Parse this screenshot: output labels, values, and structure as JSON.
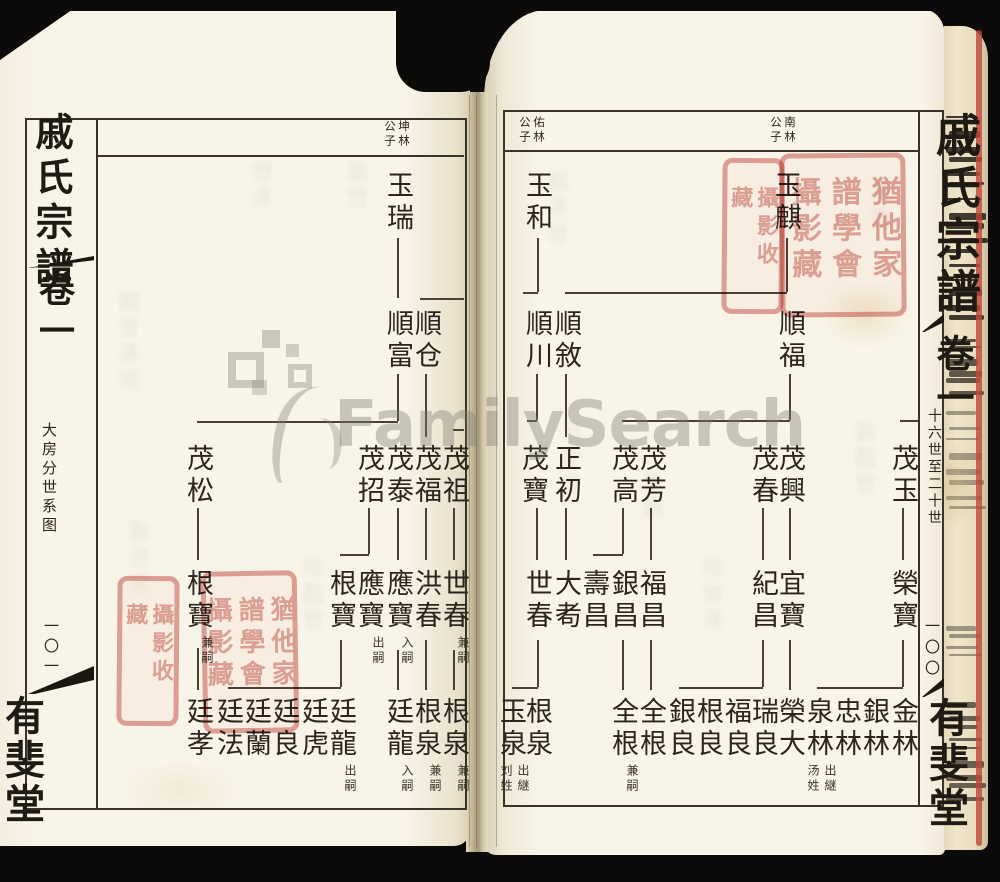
{
  "watermark": {
    "text": "FamilySearch"
  },
  "seals": {
    "large_text": "猶他家譜學會攝影藏",
    "small_text": "攝影收藏"
  },
  "pages": {
    "left": {
      "page_number": "一〇一",
      "margin": {
        "title": "戚氏宗譜",
        "volume": "卷一",
        "section": "大房分世系图",
        "hall": "有斐堂"
      },
      "headers": [
        "坤林公子"
      ],
      "nodes": [
        {
          "name": "玉瑞",
          "col": 7,
          "row": 0
        },
        {
          "name": "順富",
          "col": 7,
          "row": 1
        },
        {
          "name": "順仓",
          "col": 8,
          "row": 1
        },
        {
          "name": "茂松",
          "col": 0,
          "row": 2
        },
        {
          "name": "茂招",
          "col": 6,
          "row": 2
        },
        {
          "name": "茂泰",
          "col": 7,
          "row": 2
        },
        {
          "name": "茂福",
          "col": 8,
          "row": 2
        },
        {
          "name": "茂祖",
          "col": 9,
          "row": 2
        },
        {
          "name": "根寶",
          "note": "兼嗣",
          "col": 0,
          "row": 3
        },
        {
          "name": "根寶",
          "col": 5,
          "row": 3
        },
        {
          "name": "應寶",
          "note": "出嗣",
          "col": 6,
          "row": 3
        },
        {
          "name": "應寶",
          "note": "入嗣",
          "col": 7,
          "row": 3
        },
        {
          "name": "洪春",
          "col": 8,
          "row": 3
        },
        {
          "name": "世春",
          "note": "兼嗣",
          "col": 9,
          "row": 3
        },
        {
          "name": "廷孝",
          "col": 0,
          "row": 4
        },
        {
          "name": "廷法",
          "col": 1,
          "row": 4
        },
        {
          "name": "廷蘭",
          "col": 2,
          "row": 4
        },
        {
          "name": "廷良",
          "col": 3,
          "row": 4
        },
        {
          "name": "廷虎",
          "col": 4,
          "row": 4
        },
        {
          "name": "廷龍",
          "note": "出嗣",
          "col": 5,
          "row": 4
        },
        {
          "name": "廷龍",
          "note": "入嗣",
          "col": 7,
          "row": 4
        },
        {
          "name": "根泉",
          "note": "兼嗣",
          "col": 8,
          "row": 4
        },
        {
          "name": "根泉",
          "note": "兼嗣",
          "col": 9,
          "row": 4
        }
      ]
    },
    "right": {
      "page_number": "一〇〇",
      "margin": {
        "title": "戚氏宗譜",
        "volume": "卷一",
        "section": "十六世至二十世",
        "hall": "有斐堂"
      },
      "headers": [
        "佑林公子",
        "南林公子"
      ],
      "nodes": [
        {
          "name": "玉和",
          "col": 1,
          "row": 0
        },
        {
          "name": "玉麒",
          "col": 10,
          "row": 0,
          "dx": -4
        },
        {
          "name": "順川",
          "col": 1,
          "row": 1
        },
        {
          "name": "順敘",
          "col": 2,
          "row": 1
        },
        {
          "name": "順福",
          "col": 10,
          "row": 1
        },
        {
          "name": "茂寶",
          "col": 1,
          "row": 2,
          "dx": -4
        },
        {
          "name": "正初",
          "col": 2,
          "row": 2
        },
        {
          "name": "茂高",
          "col": 4,
          "row": 2
        },
        {
          "name": "茂芳",
          "col": 5,
          "row": 2
        },
        {
          "name": "茂春",
          "col": 9,
          "row": 2
        },
        {
          "name": "茂興",
          "col": 10,
          "row": 2
        },
        {
          "name": "茂玉",
          "col": 14,
          "row": 2
        },
        {
          "name": "世春",
          "col": 1,
          "row": 3
        },
        {
          "name": "大耇",
          "col": 2,
          "row": 3
        },
        {
          "name": "壽昌",
          "col": 3,
          "row": 3
        },
        {
          "name": "銀昌",
          "col": 4,
          "row": 3
        },
        {
          "name": "福昌",
          "col": 5,
          "row": 3
        },
        {
          "name": "紀昌",
          "col": 9,
          "row": 3
        },
        {
          "name": "宜寶",
          "col": 10,
          "row": 3
        },
        {
          "name": "榮寶",
          "col": 14,
          "row": 3
        },
        {
          "name": "玉泉",
          "note": "出継刘姓",
          "col": 0,
          "row": 4
        },
        {
          "name": "根泉",
          "col": 1,
          "row": 4
        },
        {
          "name": "全根",
          "note": "兼嗣",
          "col": 4,
          "row": 4
        },
        {
          "name": "全根",
          "col": 5,
          "row": 4
        },
        {
          "name": "銀良",
          "col": 6,
          "row": 4
        },
        {
          "name": "根良",
          "col": 7,
          "row": 4
        },
        {
          "name": "福良",
          "col": 8,
          "row": 4
        },
        {
          "name": "瑞良",
          "col": 9,
          "row": 4
        },
        {
          "name": "榮大",
          "col": 10,
          "row": 4
        },
        {
          "name": "泉林",
          "note": "出継汤姓",
          "col": 11,
          "row": 4
        },
        {
          "name": "忠林",
          "col": 12,
          "row": 4
        },
        {
          "name": "銀林",
          "col": 13,
          "row": 4
        },
        {
          "name": "金林",
          "col": 14,
          "row": 4
        }
      ]
    }
  }
}
